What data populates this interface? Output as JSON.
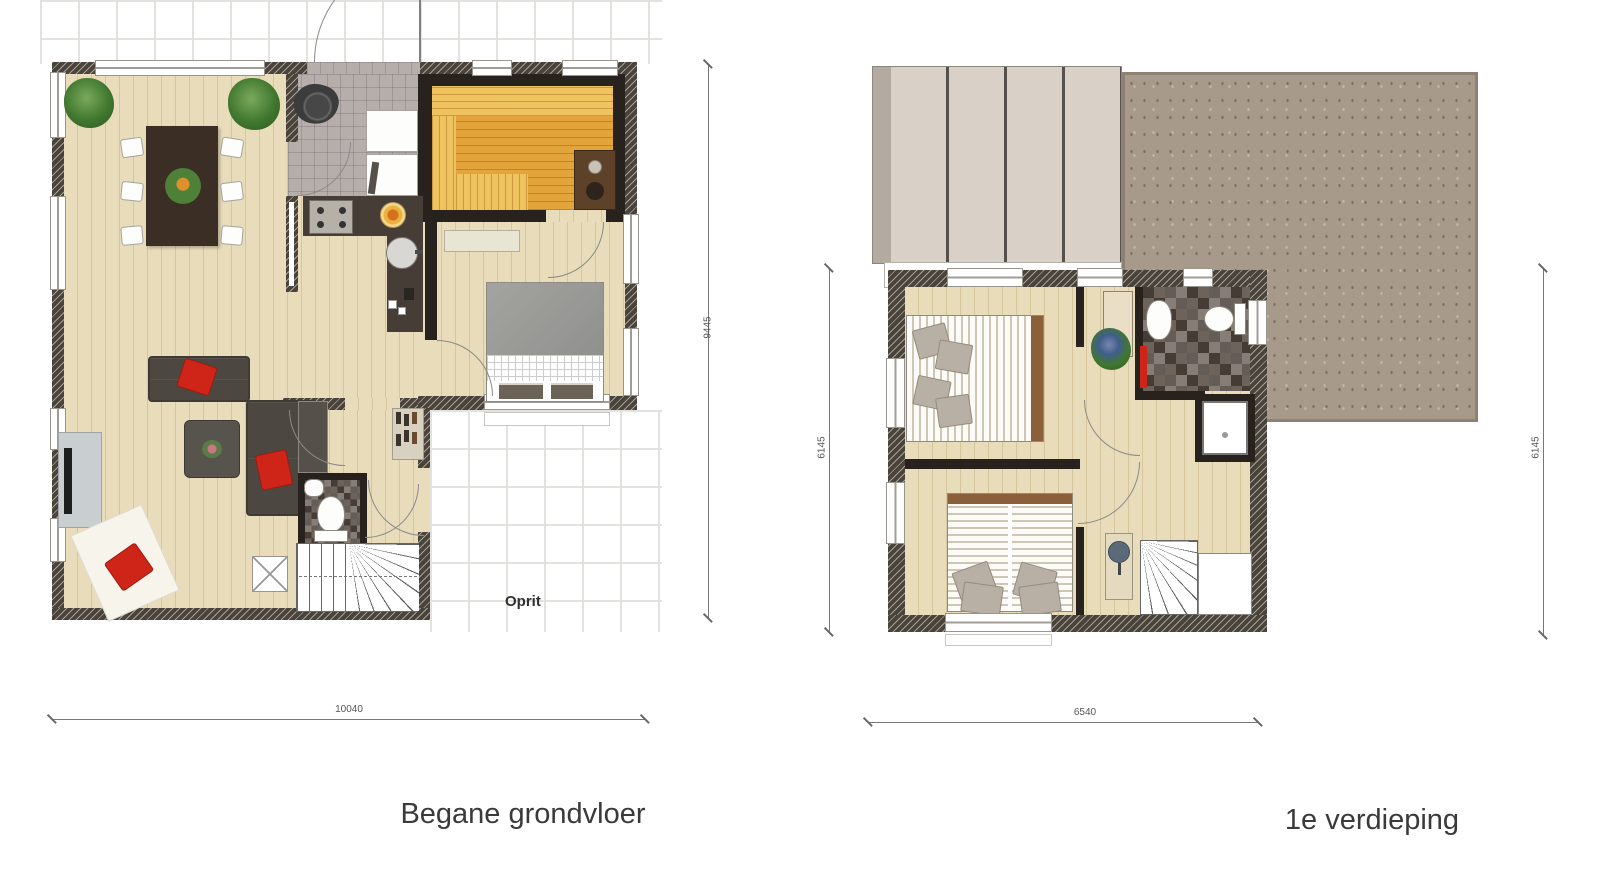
{
  "ground_floor": {
    "title": "Begane grondvloer",
    "oprit": "Oprit",
    "dim_width": "10040",
    "dim_height": "9445"
  },
  "first_floor": {
    "title": "1e verdieping",
    "dim_width": "6540",
    "dim_left": "6145",
    "dim_right": "6145"
  },
  "colors": {
    "wood": "#e8dcba",
    "wood_line": "#d6c69e",
    "wall": "#4a4339",
    "wall_dark": "#27221d",
    "tile_line": "#e4e2de",
    "hall_tile": "#b5aeab",
    "sauna": "#e3a53b",
    "sauna_light": "#efc35f",
    "kitchen": "#463e36",
    "accent_red": "#cf2519",
    "roof_flat": "#a89a8a",
    "roof_panel": "#d9d0c8",
    "roof_panel_dark": "#b3aaa1",
    "checker_dark": "#453c35",
    "checker_mid": "#6e635a",
    "sofa": "#4c4741",
    "furniture_white": "#fdfdfc",
    "table_brown": "#3b2e24",
    "text": "#3a3a3a"
  }
}
